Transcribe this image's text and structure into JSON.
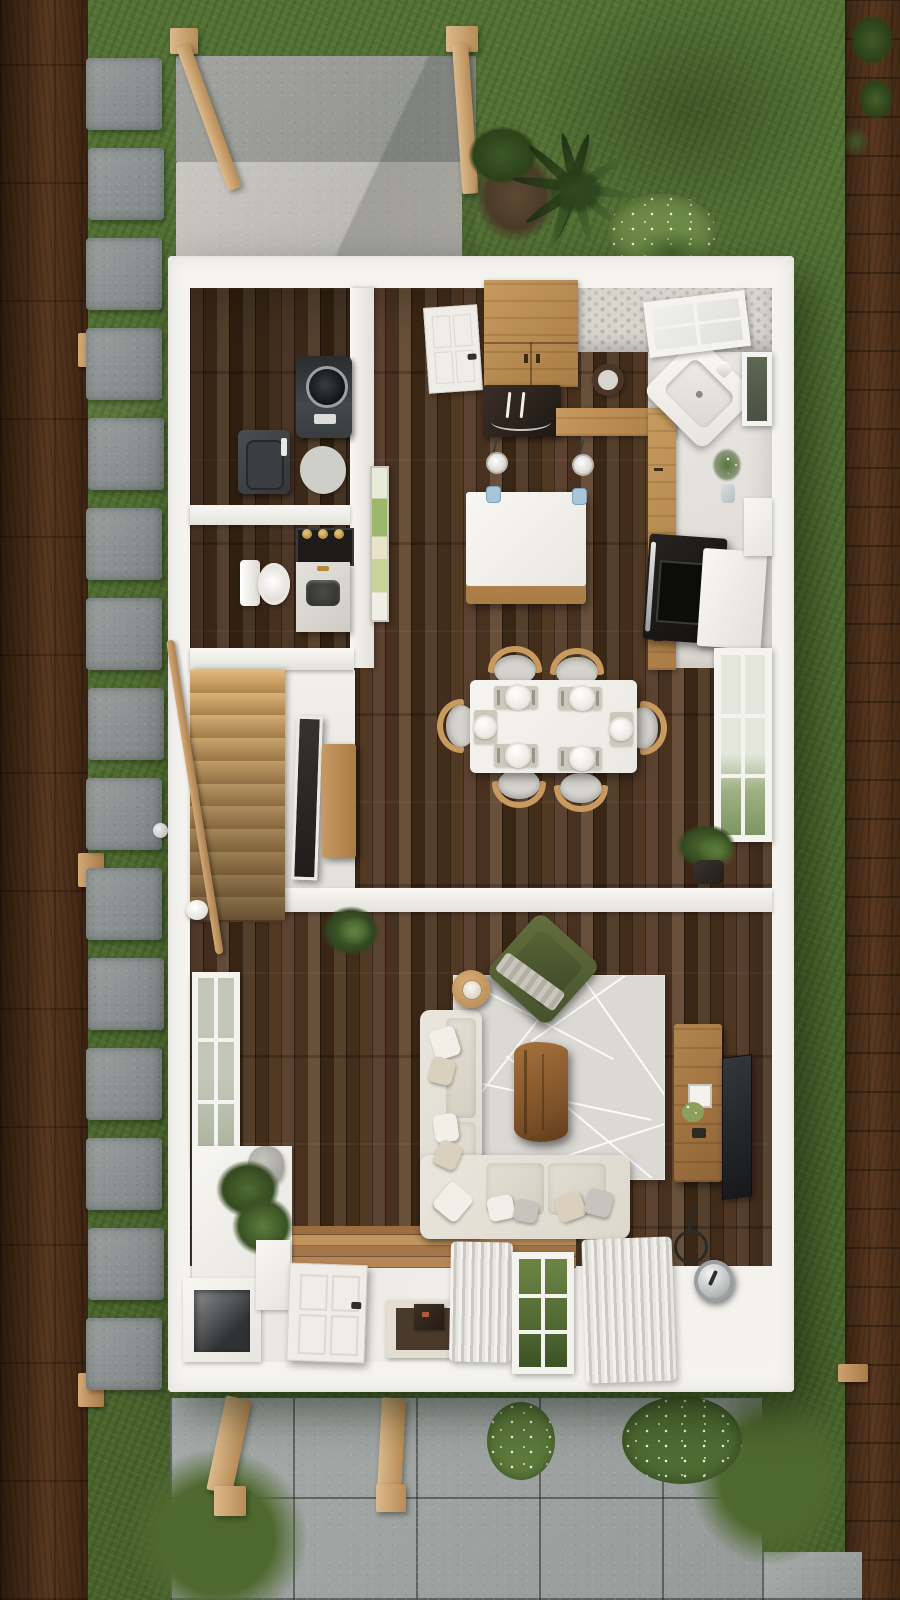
{
  "meta": {
    "description": "Photorealistic top-down 3D dollhouse render of a small house first floor with surrounding yard, stepping-stone path, wooden fences, rear patio and front paver walkway",
    "canvas": {
      "width": 900,
      "height": 1600
    },
    "visible_text": []
  },
  "palette": {
    "grass_base": "#547236",
    "grass_dark": "#3e5627",
    "fence_mid": "#5a3820",
    "rail_tan": "#d3a874",
    "stone_light": "#9aa09e",
    "concrete_dark": "#a3a4a0",
    "concrete_light": "#c9c7c2",
    "paver_grey": "#a6abaa",
    "wall_white": "#f4f3ef",
    "tile_white": "#ece9e4",
    "penny_grey": "#d8d5cf",
    "cabinet_wood": "#c79a5f",
    "floor_wood": "#4c3422",
    "island_white": "#f6f4f0",
    "fridge_dark": "#2f2621",
    "appliance_grey": "#45484b",
    "stove_black": "#1c1b1a",
    "marble": "#dedbd5",
    "brass": "#b38a3c",
    "sofa_cream": "#eae6dd",
    "rug_grey": "#dbd9d4",
    "chair_wood": "#c99a5f",
    "seat_grey": "#d5d3cd",
    "green_chair": "#55603a",
    "coffee_wood": "#8a5a30",
    "tv_dark": "#25272b",
    "plant_green": "#47632e",
    "flower_white": "#eef2df",
    "door_white": "#efede8",
    "mat_brown": "#4a3a2c",
    "glass_blue": "#a8c6d8",
    "metal_silver": "#c8cccd"
  },
  "exterior": {
    "lawn": "grass",
    "left_fence": "dark wood fence",
    "right_fence": "dark wood fence",
    "stepping_stones": {
      "count": 15
    },
    "rear_patio": {
      "upper_pad": "dark concrete",
      "lower_pad": "light concrete"
    },
    "front_walkway": "large grey pavers",
    "posts": {
      "count": 4,
      "material": "light wood"
    },
    "plants": [
      "palm-bush",
      "flowering-shrub",
      "fern",
      "vine-on-fence",
      "white-flower-bush"
    ]
  },
  "house": {
    "stairs": {
      "tread_count": 11,
      "railing": "wood handrail"
    },
    "rooms": [
      {
        "name": "laundry-room",
        "items": [
          "top-load-washer",
          "dryer",
          "oval-rug"
        ]
      },
      {
        "name": "powder-room",
        "items": [
          "toilet",
          "marble-vanity-sink",
          "mirror-with-brass-sconces"
        ]
      },
      {
        "name": "kitchen",
        "items": [
          "interior-door",
          "upper-cabinets",
          "fridge",
          "corner-sink",
          "round-mirror",
          "window",
          "kitchen-island",
          "pendant-light",
          "pendant-light",
          "range-stove",
          "white-counter",
          "wall-plant"
        ]
      },
      {
        "name": "dining-room",
        "items": [
          "dining-table",
          "dining-chair x6",
          "place-setting x6",
          "window",
          "potted-plant",
          "wood-bench",
          "leaning-mirror",
          "artwork"
        ]
      },
      {
        "name": "living-room",
        "items": [
          "sectional-sofa",
          "geometric-rug",
          "live-edge-coffee-table",
          "green-armchair",
          "round-side-table-with-lamp",
          "tv",
          "tv-console",
          "floor-lamp",
          "metal-drum-table",
          "window",
          "window-seat-with-plants",
          "potted-plant"
        ]
      },
      {
        "name": "entry",
        "items": [
          "front-door",
          "door-mat",
          "cubby-bench",
          "curtains",
          "window"
        ]
      }
    ]
  }
}
